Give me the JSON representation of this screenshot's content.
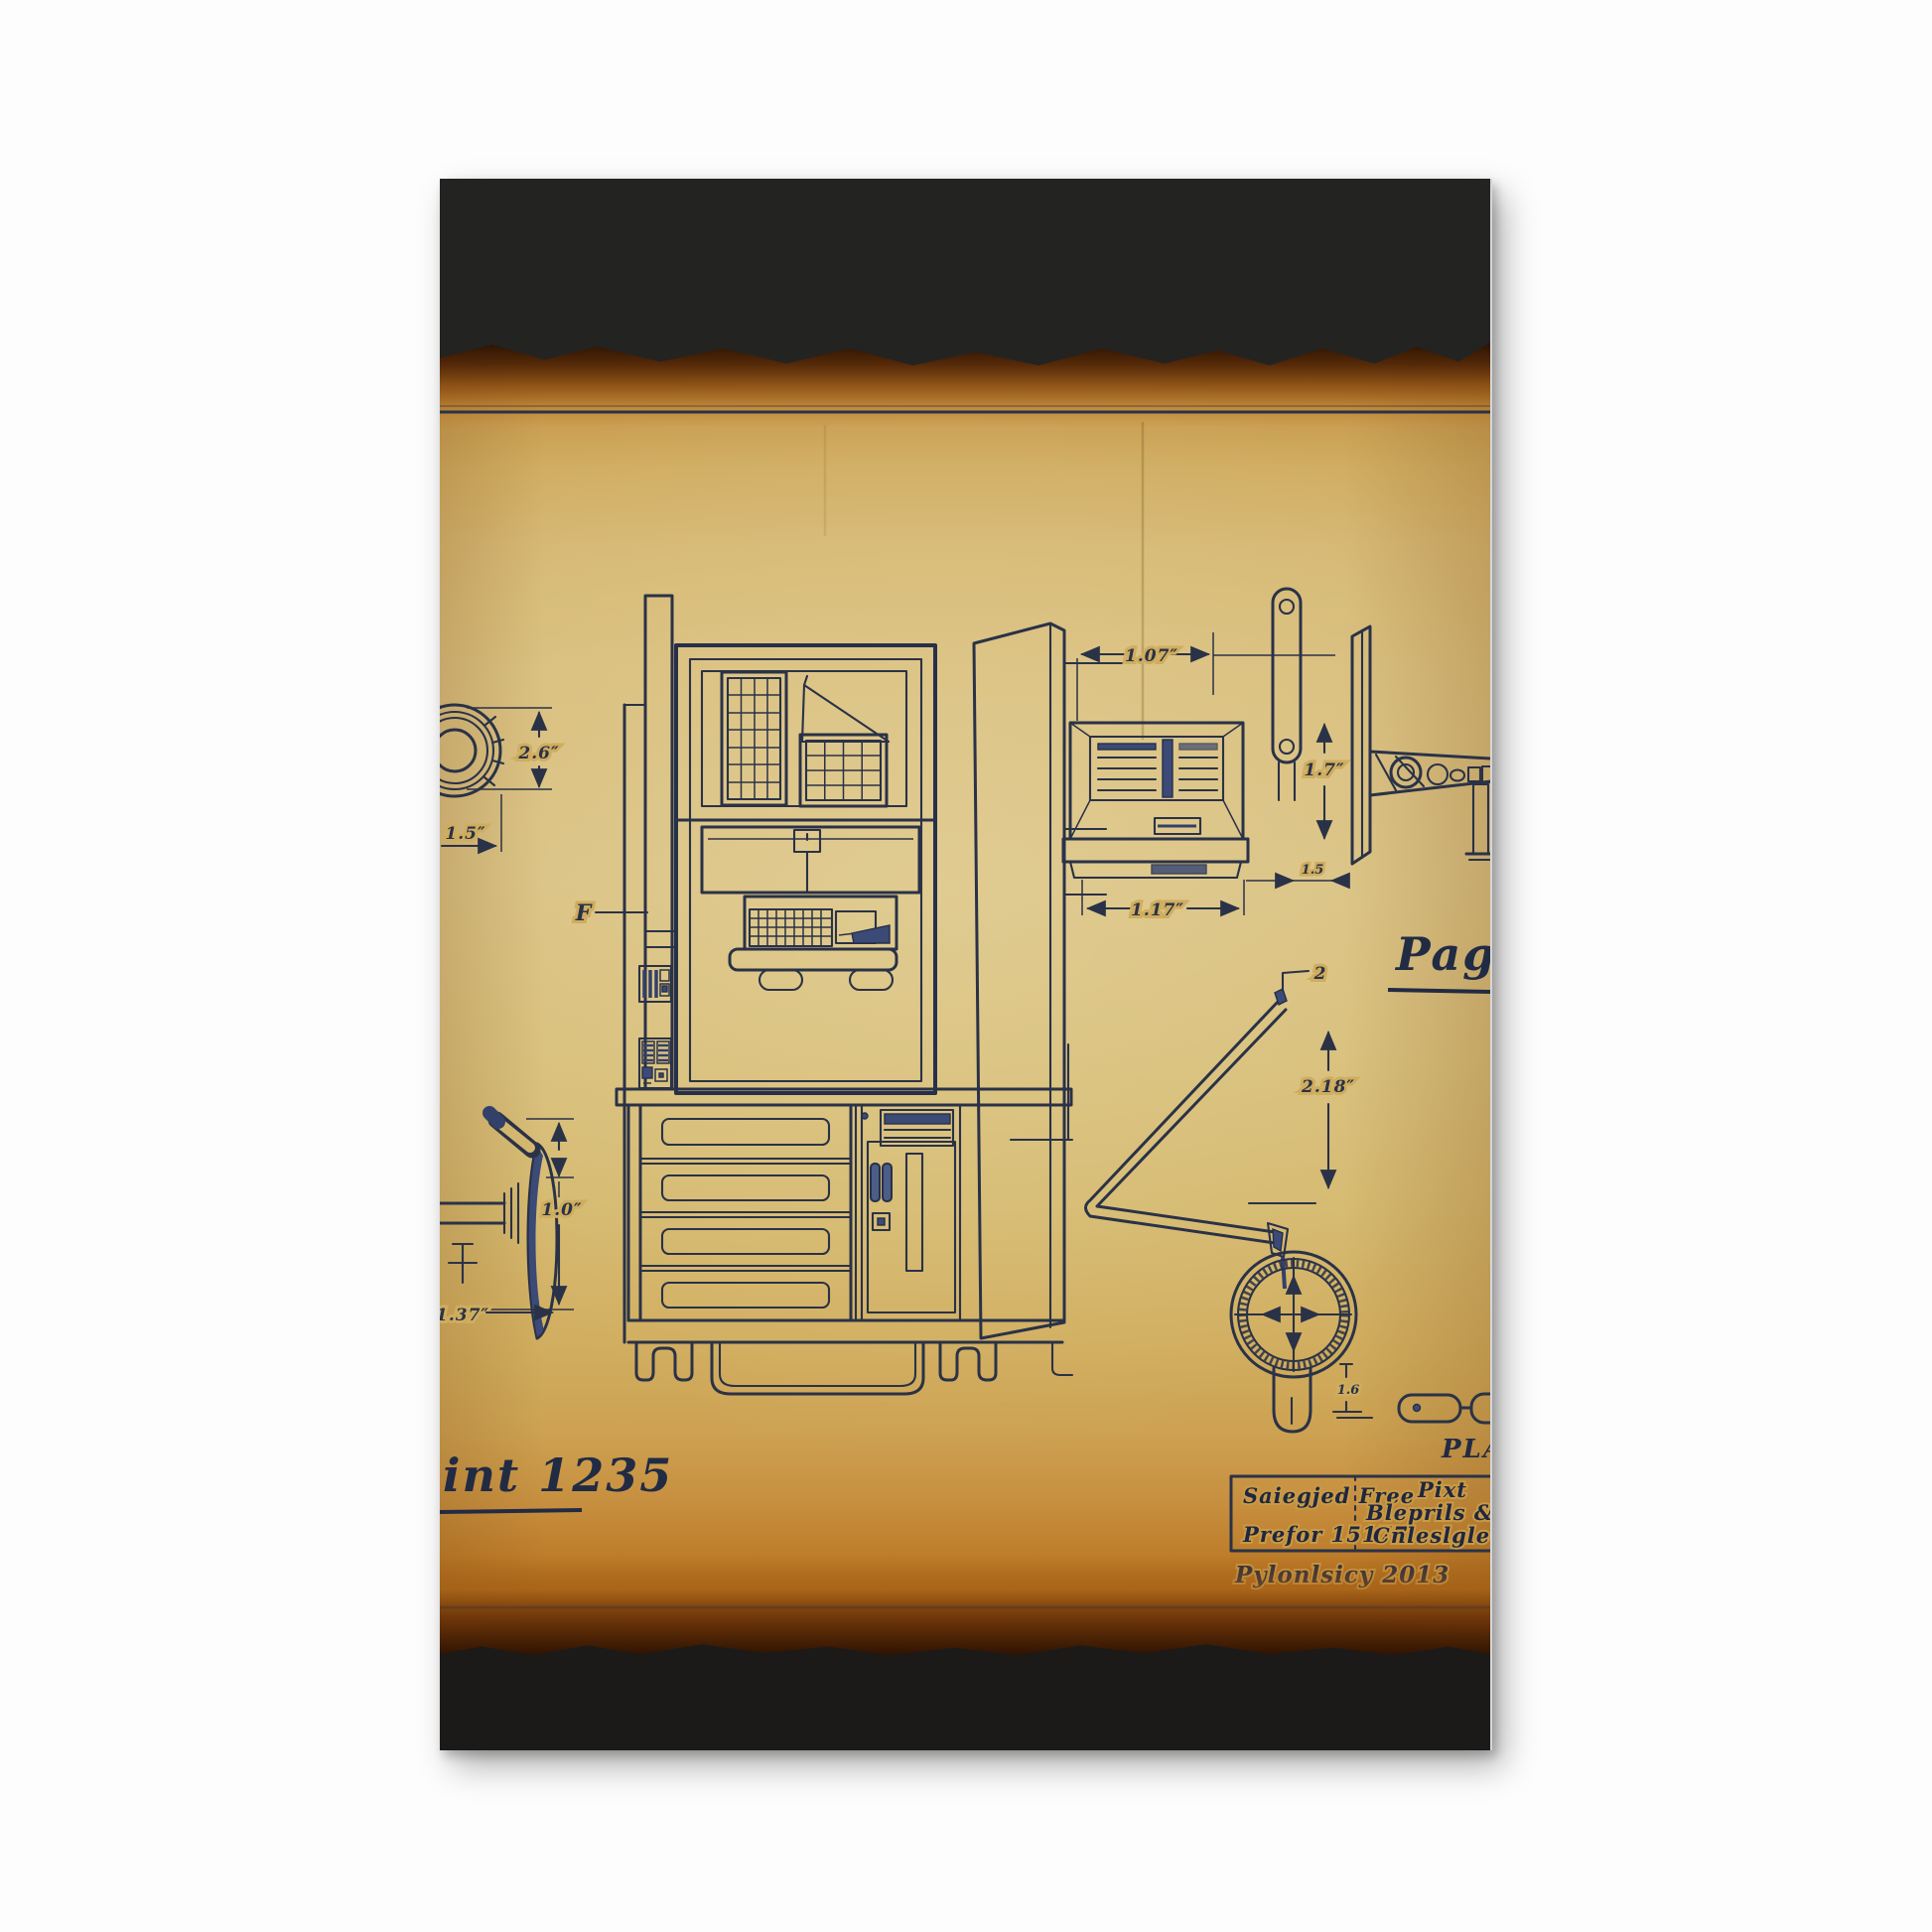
{
  "artwork": {
    "kind": "vintage blueprint technical drawing on burnt parchment, mounted canvas print",
    "colors": {
      "page_background": "#fdfdfd",
      "mat_top": "#232322",
      "mat_bottom": "#1b1a18",
      "parchment": "#d8bf7c",
      "parchment_edge_burn": "#6e3a0a",
      "ink": "#2a3247",
      "ink_fill": "#3b4a76"
    }
  },
  "annotations": {
    "knob_height": "2.6″",
    "knob_offset": "1.5″",
    "vent_width_top": "1.07″",
    "vent_width_bottom": "1.17″",
    "vent_gap": "1.5",
    "vent_height": "1.7″",
    "chute_tip": "2",
    "chute_drop": "2.18″",
    "dial_stem": "1.6",
    "lever_height": "1.0″",
    "lever_width": "1.37″",
    "front_label": "F"
  },
  "scripts": {
    "print_caption": "int 1235",
    "page_caption": "Pagi",
    "plan_caption": "PLAN",
    "date_caption": "Pylonlsicy 2013"
  },
  "title_block": {
    "cell_top_left": "Saiegjed Free",
    "cell_bottom_left": "Prefor 15177",
    "cell_top_right": "Pixt",
    "cell_mid_right": "Bleprils & Pajm",
    "cell_bottom_right": "Cnleslgle Car"
  }
}
